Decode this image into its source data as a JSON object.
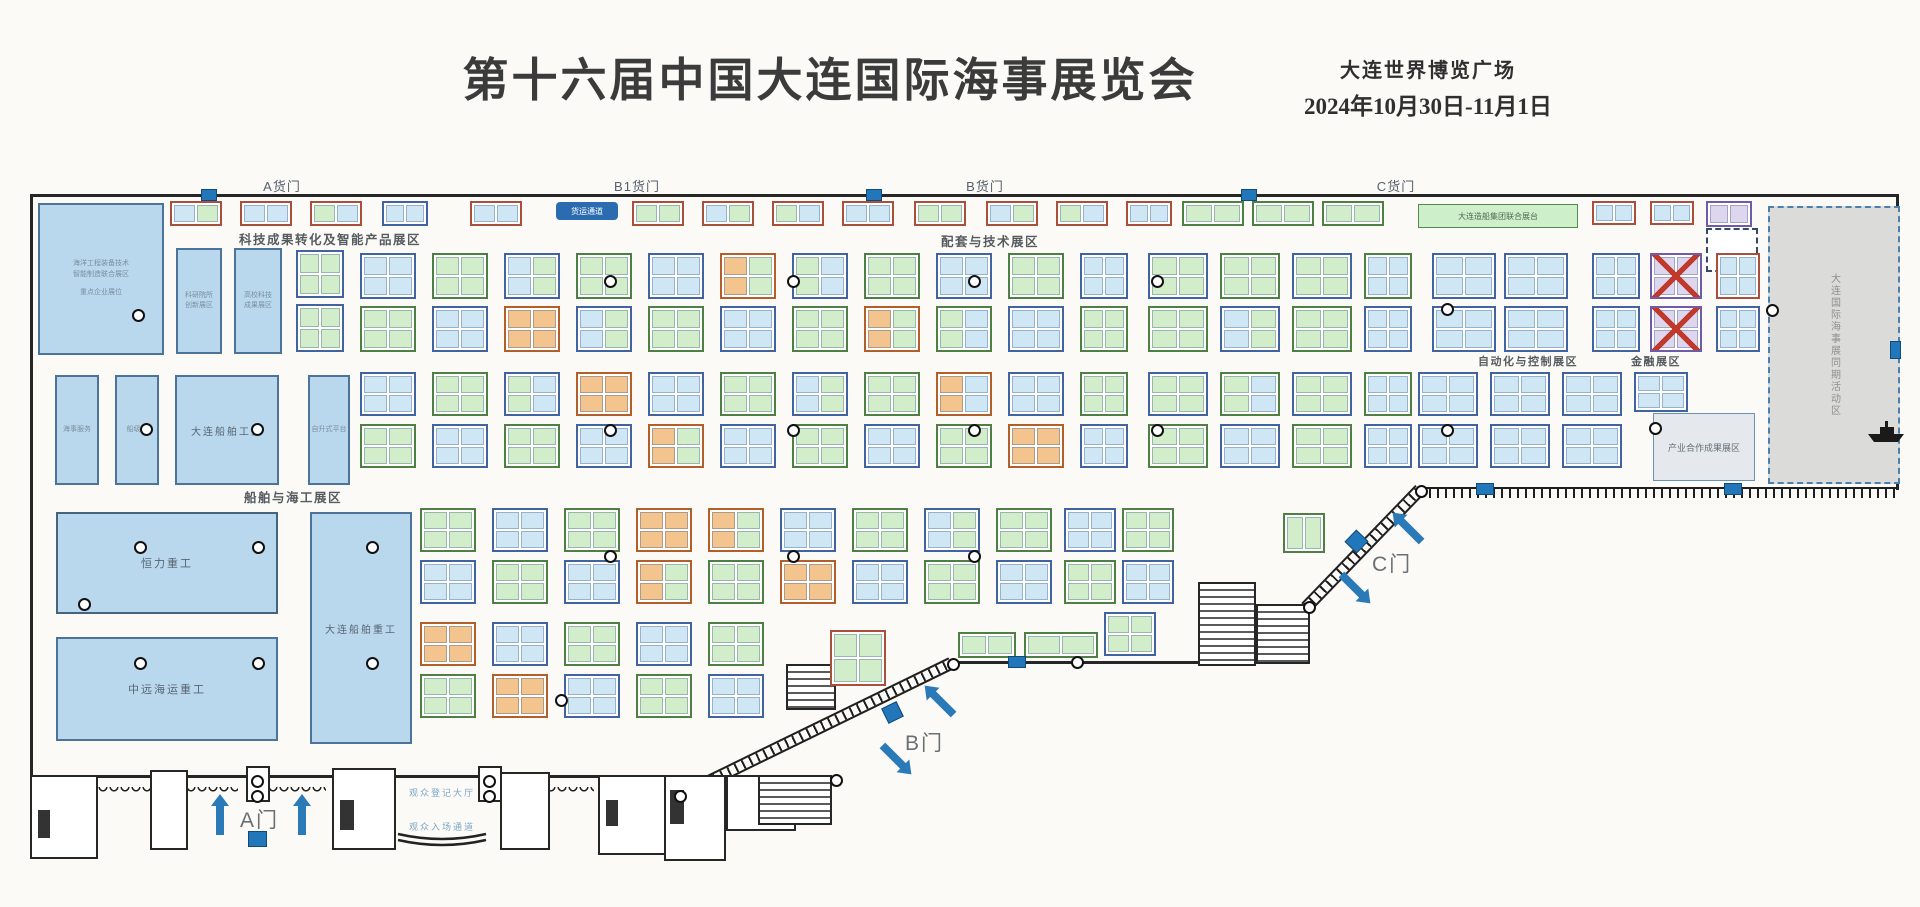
{
  "header": {
    "title": "第十六届中国大连国际海事展览会",
    "venue": "大连世界博览广场",
    "dates": "2024年10月30日-11月1日"
  },
  "gates": {
    "cargo": [
      {
        "label": "A货门"
      },
      {
        "label": "B1货门"
      },
      {
        "label": "B货门"
      },
      {
        "label": "C货门"
      }
    ],
    "doors": [
      {
        "label": "A门"
      },
      {
        "label": "B门"
      },
      {
        "label": "C门"
      }
    ]
  },
  "zones": [
    {
      "label": "科技成果转化及智能产品展区"
    },
    {
      "label": "配套与技术展区"
    },
    {
      "label": "船舶与海工展区"
    },
    {
      "label": "自动化与控制展区"
    },
    {
      "label": "金融展区"
    },
    {
      "label": "产业合作成果展区"
    }
  ],
  "booths": {
    "hero": [
      {
        "name": "恒力重工"
      },
      {
        "name": "中远海运重工"
      },
      {
        "name": "大连船舶重工"
      },
      {
        "name": "大连船舶工业"
      }
    ],
    "left_block_lines": [
      "海洋工程装备技术",
      "智能制造联合展区",
      "重点企业展位"
    ],
    "narrow_blocks": [
      {
        "line1": "科研院所",
        "line2": "创新展区"
      },
      {
        "line1": "高校科技",
        "line2": "成果展区"
      }
    ],
    "small_blocks": [
      {
        "name": "海事服务"
      },
      {
        "name": "船级社"
      },
      {
        "name": "自升式平台"
      }
    ],
    "activity_area": "大连国际海事展同期活动区",
    "freight_pill": "货运通道",
    "green_bar": "大连造船集团联合展台",
    "visitor_labels": [
      {
        "label": "观众登记大厅"
      },
      {
        "label": "观众入场通道"
      }
    ]
  },
  "floorplan": {
    "clusters": [
      [
        170,
        201,
        52,
        25,
        "r",
        "cg",
        2,
        1
      ],
      [
        240,
        201,
        52,
        25,
        "r",
        "cc",
        2,
        1
      ],
      [
        310,
        201,
        52,
        25,
        "r",
        "gc",
        2,
        1
      ],
      [
        382,
        201,
        46,
        25,
        "b",
        "cc",
        2,
        1
      ],
      [
        470,
        201,
        52,
        25,
        "r",
        "cc",
        2,
        1
      ],
      [
        632,
        201,
        52,
        25,
        "r",
        "gg",
        2,
        1
      ],
      [
        702,
        201,
        52,
        25,
        "r",
        "cg",
        2,
        1
      ],
      [
        772,
        201,
        52,
        25,
        "r",
        "gc",
        2,
        1
      ],
      [
        842,
        201,
        52,
        25,
        "r",
        "cc",
        2,
        1
      ],
      [
        914,
        201,
        52,
        25,
        "r",
        "gg",
        2,
        1
      ],
      [
        986,
        201,
        52,
        25,
        "r",
        "cg",
        2,
        1
      ],
      [
        1056,
        201,
        52,
        25,
        "r",
        "gc",
        2,
        1
      ],
      [
        1126,
        201,
        46,
        25,
        "r",
        "cc",
        2,
        1
      ],
      [
        1182,
        201,
        62,
        25,
        "g",
        "gg",
        2,
        1
      ],
      [
        1252,
        201,
        62,
        25,
        "g",
        "gg",
        2,
        1
      ],
      [
        1322,
        201,
        62,
        25,
        "g",
        "gg",
        2,
        1
      ],
      [
        1592,
        201,
        44,
        24,
        "r",
        "cc",
        2,
        1
      ],
      [
        1650,
        201,
        44,
        24,
        "r",
        "cc",
        2,
        1
      ],
      [
        1706,
        201,
        46,
        26,
        "p",
        "vv",
        2,
        1
      ],
      [
        296,
        250,
        48,
        48,
        "b",
        "gg",
        2,
        2
      ],
      [
        296,
        304,
        48,
        48,
        "b",
        "gg",
        2,
        2
      ],
      [
        360,
        253,
        56,
        46,
        "b",
        "cc",
        2,
        2
      ],
      [
        432,
        253,
        56,
        46,
        "g",
        "gg",
        2,
        2
      ],
      [
        504,
        253,
        56,
        46,
        "b",
        "cg",
        2,
        2
      ],
      [
        576,
        253,
        56,
        46,
        "g",
        "gg",
        2,
        2
      ],
      [
        648,
        253,
        56,
        46,
        "b",
        "cc",
        2,
        2
      ],
      [
        720,
        253,
        56,
        46,
        "o",
        "og",
        2,
        2
      ],
      [
        792,
        253,
        56,
        46,
        "b",
        "gc",
        2,
        2
      ],
      [
        864,
        253,
        56,
        46,
        "g",
        "gg",
        2,
        2
      ],
      [
        936,
        253,
        56,
        46,
        "b",
        "cc",
        2,
        2
      ],
      [
        1008,
        253,
        56,
        46,
        "g",
        "gg",
        2,
        2
      ],
      [
        1080,
        253,
        48,
        46,
        "b",
        "cc",
        2,
        2
      ],
      [
        1148,
        253,
        60,
        46,
        "b",
        "gg",
        2,
        2
      ],
      [
        1220,
        253,
        60,
        46,
        "g",
        "gg",
        2,
        2
      ],
      [
        1292,
        253,
        60,
        46,
        "b",
        "gg",
        2,
        2
      ],
      [
        1364,
        253,
        48,
        46,
        "g",
        "cc",
        2,
        2
      ],
      [
        1432,
        253,
        64,
        46,
        "b",
        "cc",
        2,
        2
      ],
      [
        1504,
        253,
        64,
        46,
        "b",
        "cc",
        2,
        2
      ],
      [
        1592,
        253,
        48,
        46,
        "b",
        "cc",
        2,
        2
      ],
      [
        1650,
        253,
        52,
        46,
        "p",
        "vv",
        2,
        2,
        1
      ],
      [
        1716,
        253,
        44,
        46,
        "r",
        "cc",
        2,
        2
      ],
      [
        360,
        306,
        56,
        46,
        "g",
        "gg",
        2,
        2
      ],
      [
        432,
        306,
        56,
        46,
        "b",
        "cc",
        2,
        2
      ],
      [
        504,
        306,
        56,
        46,
        "o",
        "oo",
        2,
        2
      ],
      [
        576,
        306,
        56,
        46,
        "b",
        "cg",
        2,
        2
      ],
      [
        648,
        306,
        56,
        46,
        "g",
        "gg",
        2,
        2
      ],
      [
        720,
        306,
        56,
        46,
        "b",
        "cc",
        2,
        2
      ],
      [
        792,
        306,
        56,
        46,
        "g",
        "gg",
        2,
        2
      ],
      [
        864,
        306,
        56,
        46,
        "o",
        "og",
        2,
        2
      ],
      [
        936,
        306,
        56,
        46,
        "g",
        "gc",
        2,
        2
      ],
      [
        1008,
        306,
        56,
        46,
        "b",
        "cc",
        2,
        2
      ],
      [
        1080,
        306,
        48,
        46,
        "g",
        "gg",
        2,
        2
      ],
      [
        1148,
        306,
        60,
        46,
        "g",
        "gg",
        2,
        2
      ],
      [
        1220,
        306,
        60,
        46,
        "b",
        "cg",
        2,
        2
      ],
      [
        1292,
        306,
        60,
        46,
        "g",
        "gg",
        2,
        2
      ],
      [
        1364,
        306,
        48,
        46,
        "b",
        "cc",
        2,
        2
      ],
      [
        1432,
        306,
        64,
        46,
        "b",
        "cc",
        2,
        2
      ],
      [
        1504,
        306,
        64,
        46,
        "b",
        "cc",
        2,
        2
      ],
      [
        1592,
        306,
        48,
        46,
        "b",
        "cc",
        2,
        2
      ],
      [
        1650,
        306,
        52,
        46,
        "p",
        "vv",
        2,
        2,
        1
      ],
      [
        1716,
        306,
        44,
        46,
        "b",
        "cc",
        2,
        2
      ],
      [
        360,
        372,
        56,
        44,
        "b",
        "cc",
        2,
        2
      ],
      [
        432,
        372,
        56,
        44,
        "g",
        "gg",
        2,
        2
      ],
      [
        504,
        372,
        56,
        44,
        "b",
        "gc",
        2,
        2
      ],
      [
        576,
        372,
        56,
        44,
        "o",
        "oo",
        2,
        2
      ],
      [
        648,
        372,
        56,
        44,
        "b",
        "cc",
        2,
        2
      ],
      [
        720,
        372,
        56,
        44,
        "g",
        "gg",
        2,
        2
      ],
      [
        792,
        372,
        56,
        44,
        "b",
        "cg",
        2,
        2
      ],
      [
        864,
        372,
        56,
        44,
        "g",
        "gg",
        2,
        2
      ],
      [
        936,
        372,
        56,
        44,
        "o",
        "oc",
        2,
        2
      ],
      [
        1008,
        372,
        56,
        44,
        "b",
        "cc",
        2,
        2
      ],
      [
        1080,
        372,
        48,
        44,
        "g",
        "gg",
        2,
        2
      ],
      [
        1148,
        372,
        60,
        44,
        "b",
        "gg",
        2,
        2
      ],
      [
        1220,
        372,
        60,
        44,
        "g",
        "gc",
        2,
        2
      ],
      [
        1292,
        372,
        60,
        44,
        "b",
        "gg",
        2,
        2
      ],
      [
        1364,
        372,
        48,
        44,
        "g",
        "cc",
        2,
        2
      ],
      [
        1418,
        372,
        60,
        44,
        "b",
        "cc",
        2,
        2
      ],
      [
        1490,
        372,
        60,
        44,
        "b",
        "cc",
        2,
        2
      ],
      [
        1562,
        372,
        60,
        44,
        "b",
        "cc",
        2,
        2
      ],
      [
        1634,
        372,
        54,
        40,
        "b",
        "cc",
        2,
        2
      ],
      [
        360,
        424,
        56,
        44,
        "g",
        "gg",
        2,
        2
      ],
      [
        432,
        424,
        56,
        44,
        "b",
        "cc",
        2,
        2
      ],
      [
        504,
        424,
        56,
        44,
        "g",
        "gg",
        2,
        2
      ],
      [
        576,
        424,
        56,
        44,
        "b",
        "cc",
        2,
        2
      ],
      [
        648,
        424,
        56,
        44,
        "o",
        "og",
        2,
        2
      ],
      [
        720,
        424,
        56,
        44,
        "b",
        "cc",
        2,
        2
      ],
      [
        792,
        424,
        56,
        44,
        "g",
        "gg",
        2,
        2
      ],
      [
        864,
        424,
        56,
        44,
        "b",
        "cc",
        2,
        2
      ],
      [
        936,
        424,
        56,
        44,
        "g",
        "gg",
        2,
        2
      ],
      [
        1008,
        424,
        56,
        44,
        "o",
        "oo",
        2,
        2
      ],
      [
        1080,
        424,
        48,
        44,
        "b",
        "cc",
        2,
        2
      ],
      [
        1148,
        424,
        60,
        44,
        "g",
        "gg",
        2,
        2
      ],
      [
        1220,
        424,
        60,
        44,
        "b",
        "cc",
        2,
        2
      ],
      [
        1292,
        424,
        60,
        44,
        "g",
        "gg",
        2,
        2
      ],
      [
        1364,
        424,
        48,
        44,
        "b",
        "cc",
        2,
        2
      ],
      [
        1418,
        424,
        60,
        44,
        "b",
        "cc",
        2,
        2
      ],
      [
        1490,
        424,
        60,
        44,
        "b",
        "cc",
        2,
        2
      ],
      [
        1562,
        424,
        60,
        44,
        "b",
        "cc",
        2,
        2
      ],
      [
        420,
        508,
        56,
        44,
        "g",
        "gg",
        2,
        2
      ],
      [
        492,
        508,
        56,
        44,
        "b",
        "cc",
        2,
        2
      ],
      [
        564,
        508,
        56,
        44,
        "g",
        "gg",
        2,
        2
      ],
      [
        636,
        508,
        56,
        44,
        "o",
        "oo",
        2,
        2
      ],
      [
        708,
        508,
        56,
        44,
        "o",
        "og",
        2,
        2
      ],
      [
        780,
        508,
        56,
        44,
        "b",
        "cc",
        2,
        2
      ],
      [
        852,
        508,
        56,
        44,
        "g",
        "gg",
        2,
        2
      ],
      [
        924,
        508,
        56,
        44,
        "b",
        "cg",
        2,
        2
      ],
      [
        996,
        508,
        56,
        44,
        "g",
        "gg",
        2,
        2
      ],
      [
        1064,
        508,
        52,
        44,
        "b",
        "cc",
        2,
        2
      ],
      [
        1122,
        508,
        52,
        44,
        "g",
        "gg",
        2,
        2
      ],
      [
        1283,
        513,
        42,
        40,
        "g",
        "gg",
        2,
        1
      ],
      [
        420,
        560,
        56,
        44,
        "b",
        "cc",
        2,
        2
      ],
      [
        492,
        560,
        56,
        44,
        "g",
        "gg",
        2,
        2
      ],
      [
        564,
        560,
        56,
        44,
        "b",
        "cc",
        2,
        2
      ],
      [
        636,
        560,
        56,
        44,
        "o",
        "og",
        2,
        2
      ],
      [
        708,
        560,
        56,
        44,
        "g",
        "gg",
        2,
        2
      ],
      [
        780,
        560,
        56,
        44,
        "o",
        "oo",
        2,
        2
      ],
      [
        852,
        560,
        56,
        44,
        "b",
        "cc",
        2,
        2
      ],
      [
        924,
        560,
        56,
        44,
        "g",
        "gg",
        2,
        2
      ],
      [
        996,
        560,
        56,
        44,
        "b",
        "cc",
        2,
        2
      ],
      [
        1064,
        560,
        52,
        44,
        "g",
        "gg",
        2,
        2
      ],
      [
        1122,
        560,
        52,
        44,
        "b",
        "cc",
        2,
        2
      ],
      [
        958,
        632,
        58,
        26,
        "g",
        "gg",
        2,
        1
      ],
      [
        1024,
        632,
        74,
        26,
        "g",
        "gg",
        2,
        1
      ],
      [
        1104,
        612,
        52,
        44,
        "b",
        "gg",
        2,
        2
      ],
      [
        420,
        622,
        56,
        44,
        "o",
        "oo",
        2,
        2
      ],
      [
        492,
        622,
        56,
        44,
        "b",
        "cc",
        2,
        2
      ],
      [
        564,
        622,
        56,
        44,
        "g",
        "gg",
        2,
        2
      ],
      [
        636,
        622,
        56,
        44,
        "b",
        "cc",
        2,
        2
      ],
      [
        708,
        622,
        56,
        44,
        "g",
        "gg",
        2,
        2
      ],
      [
        830,
        630,
        56,
        56,
        "r",
        "gggg",
        2,
        2
      ],
      [
        420,
        674,
        56,
        44,
        "g",
        "gg",
        2,
        2
      ],
      [
        492,
        674,
        56,
        44,
        "o",
        "oo",
        2,
        2
      ],
      [
        564,
        674,
        56,
        44,
        "b",
        "cc",
        2,
        2
      ],
      [
        636,
        674,
        56,
        44,
        "g",
        "gg",
        2,
        2
      ],
      [
        708,
        674,
        56,
        44,
        "b",
        "cc",
        2,
        2
      ]
    ],
    "pillars": [
      [
        138,
        315
      ],
      [
        146,
        429
      ],
      [
        257,
        429
      ],
      [
        84,
        604
      ],
      [
        140,
        547
      ],
      [
        258,
        547
      ],
      [
        140,
        663
      ],
      [
        258,
        663
      ],
      [
        372,
        547
      ],
      [
        372,
        663
      ],
      [
        610,
        281
      ],
      [
        793,
        281
      ],
      [
        974,
        281
      ],
      [
        1157,
        281
      ],
      [
        610,
        430
      ],
      [
        793,
        430
      ],
      [
        974,
        430
      ],
      [
        1157,
        430
      ],
      [
        1447,
        309
      ],
      [
        1447,
        430
      ],
      [
        1655,
        428
      ],
      [
        1772,
        310
      ],
      [
        610,
        556
      ],
      [
        793,
        556
      ],
      [
        974,
        556
      ],
      [
        561,
        700
      ],
      [
        953,
        664
      ],
      [
        1309,
        607
      ],
      [
        1421,
        491
      ],
      [
        680,
        796
      ],
      [
        836,
        780
      ],
      [
        257,
        781
      ],
      [
        257,
        796
      ],
      [
        489,
        781
      ],
      [
        489,
        796
      ],
      [
        1077,
        662
      ]
    ],
    "doors": [
      [
        201,
        189,
        14,
        10,
        0
      ],
      [
        866,
        189,
        14,
        10,
        0
      ],
      [
        1241,
        189,
        14,
        10,
        0
      ],
      [
        1008,
        656,
        16,
        10,
        0
      ],
      [
        1476,
        483,
        16,
        10,
        0
      ],
      [
        1724,
        483,
        16,
        10,
        0
      ],
      [
        1890,
        341,
        9,
        16,
        0
      ],
      [
        884,
        704,
        15,
        15,
        -26
      ],
      [
        1348,
        533,
        15,
        15,
        -46
      ],
      [
        248,
        831,
        17,
        14,
        0
      ]
    ],
    "arrows": [
      [
        205,
        816,
        -90
      ],
      [
        287,
        816,
        -90
      ],
      [
        928,
        700,
        -135
      ],
      [
        878,
        752,
        45
      ],
      [
        1396,
        527,
        -135
      ],
      [
        1337,
        581,
        45
      ]
    ]
  }
}
